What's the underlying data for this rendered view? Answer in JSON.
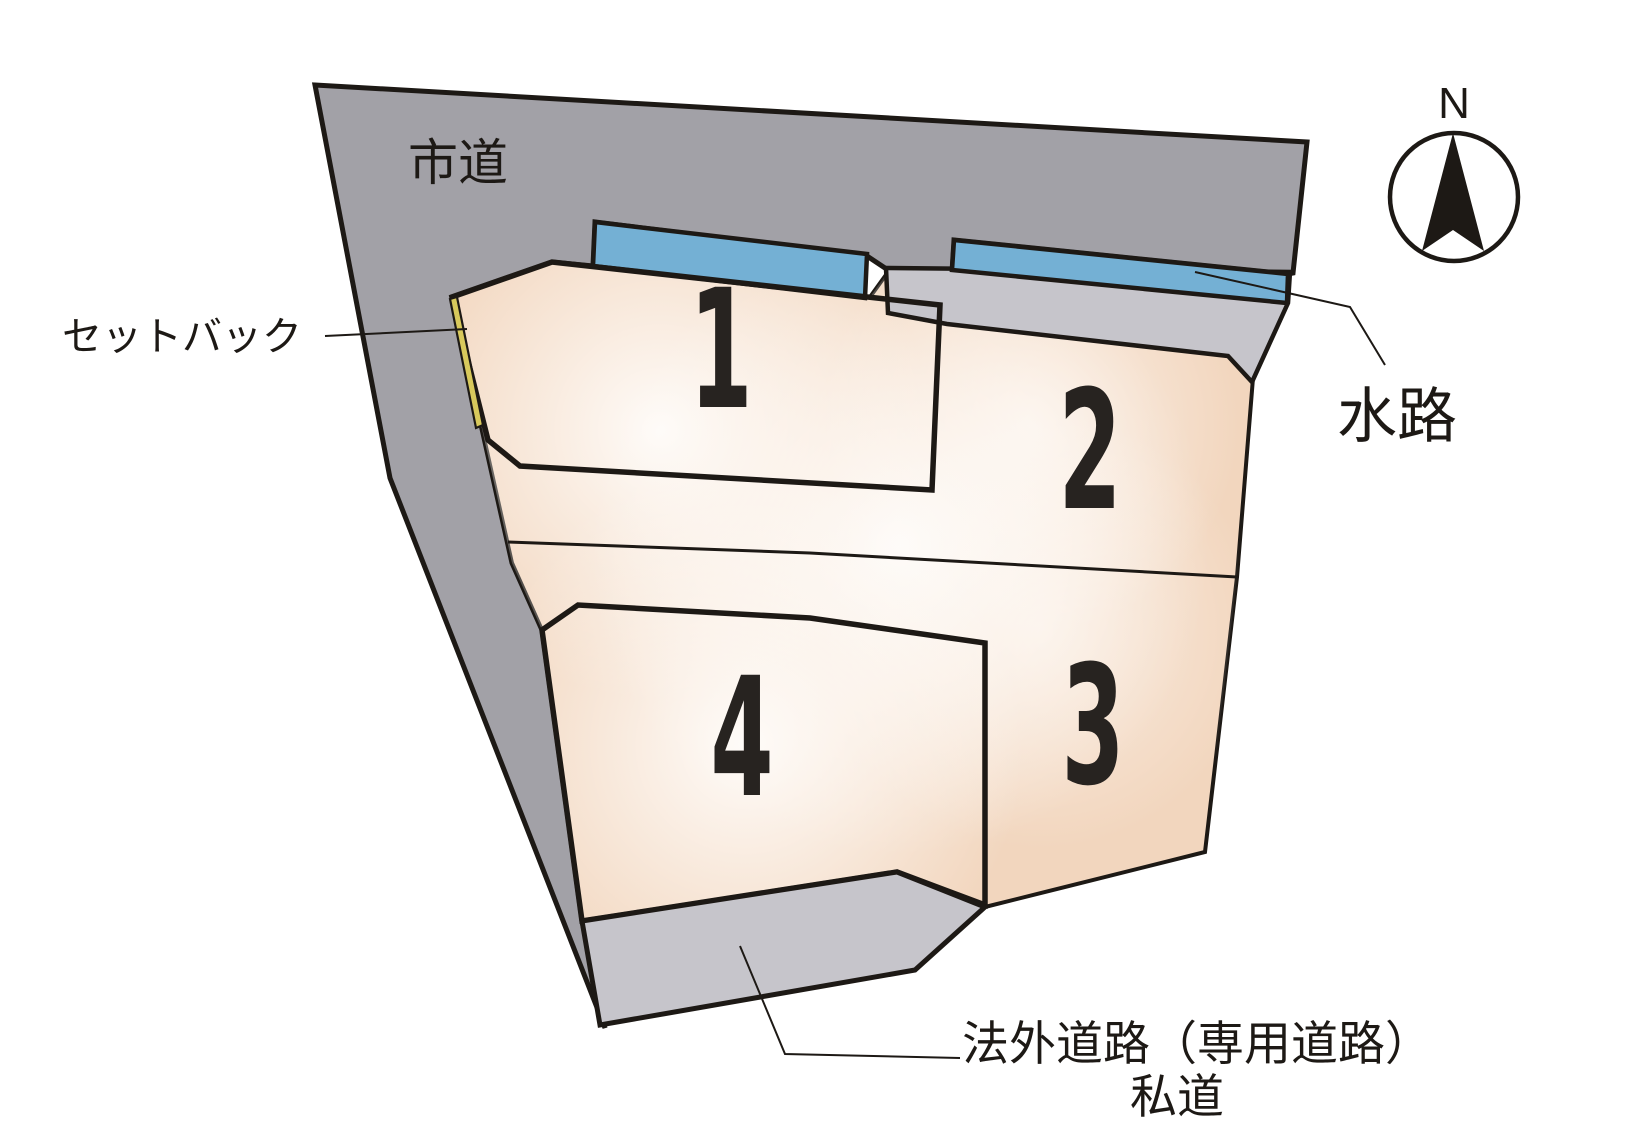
{
  "labels": {
    "city_road": "市道",
    "setback": "セットバック",
    "waterway": "水路",
    "private_road_line1": "法外道路（専用道路）",
    "private_road_line2": "私道",
    "compass_north": "N"
  },
  "lots": [
    {
      "number": "1"
    },
    {
      "number": "2"
    },
    {
      "number": "3"
    },
    {
      "number": "4"
    }
  ],
  "colors": {
    "road_gray": "#a2a1a7",
    "path_gray": "#c6c5cb",
    "waterway_blue": "#74b0d4",
    "parcel_peach": "#f2d6be",
    "setback_yellow": "#d8c95c",
    "digit_color": "#272320",
    "line_dark": "#1d1915"
  }
}
